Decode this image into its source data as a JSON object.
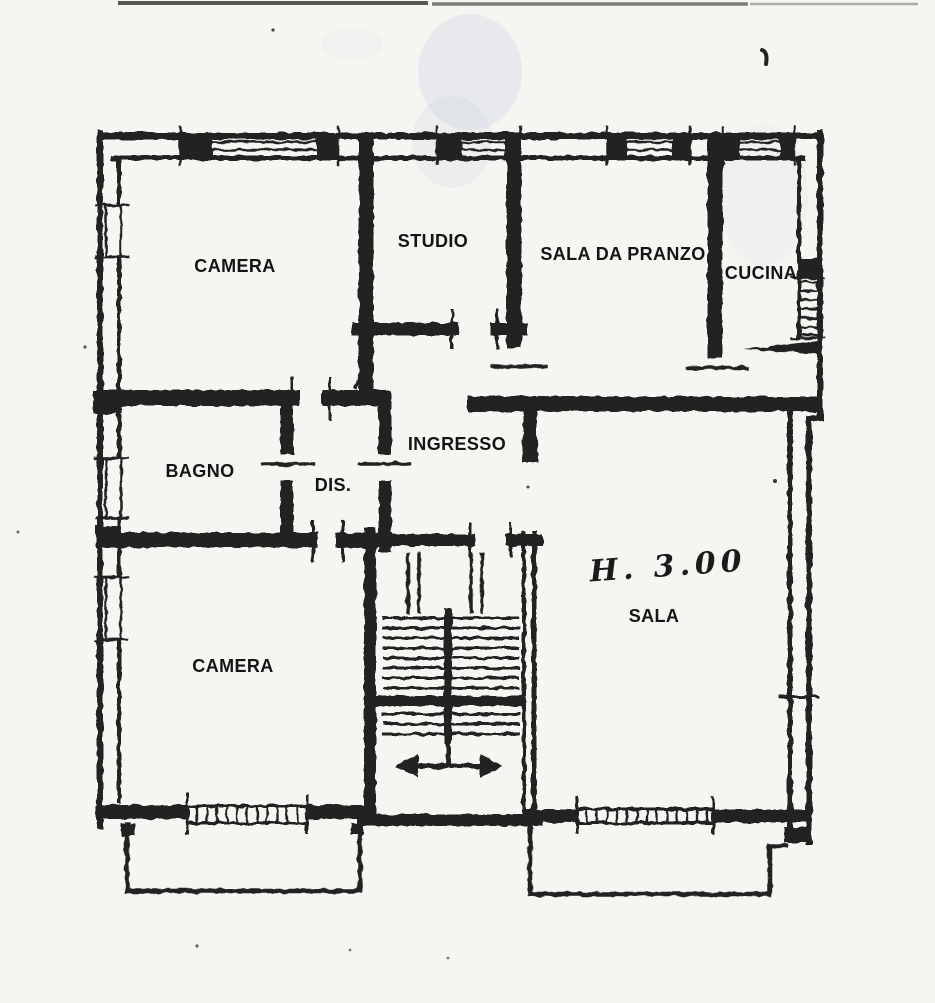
{
  "document": {
    "kind": "scanned apartment floor plan",
    "paper_color": "#f6f5f2",
    "ink_color": "#202020"
  },
  "floor_plan": {
    "rooms": [
      {
        "id": "camera-1",
        "label": "CAMERA",
        "x": 235,
        "y": 272
      },
      {
        "id": "studio",
        "label": "STUDIO",
        "x": 433,
        "y": 247
      },
      {
        "id": "sala-da-pranzo",
        "label": "SALA DA PRANZO",
        "x": 623,
        "y": 260
      },
      {
        "id": "cucina",
        "label": "CUCINA",
        "x": 761,
        "y": 279
      },
      {
        "id": "bagno",
        "label": "BAGNO",
        "x": 200,
        "y": 477
      },
      {
        "id": "dis",
        "label": "DIS.",
        "x": 333,
        "y": 491
      },
      {
        "id": "ingresso",
        "label": "INGRESSO",
        "x": 457,
        "y": 450
      },
      {
        "id": "sala",
        "label": "SALA",
        "x": 654,
        "y": 622
      },
      {
        "id": "camera-2",
        "label": "CAMERA",
        "x": 233,
        "y": 672
      }
    ],
    "annotation": {
      "text": "H. 3.00",
      "x": 668,
      "y": 576
    }
  }
}
